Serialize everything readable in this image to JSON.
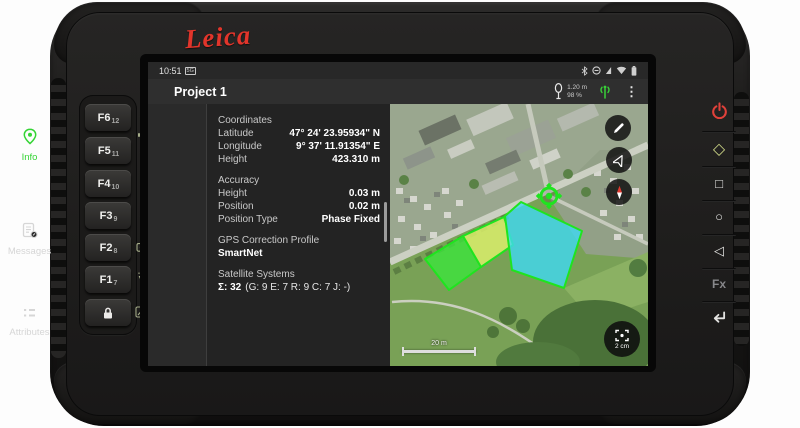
{
  "device": {
    "brand": "Leica",
    "left_keys": [
      {
        "label": "F6",
        "sub": "12"
      },
      {
        "label": "F5",
        "sub": "11"
      },
      {
        "label": "F4",
        "sub": "10"
      },
      {
        "label": "F3",
        "sub": "9"
      },
      {
        "label": "F2",
        "sub": "8"
      },
      {
        "label": "F1",
        "sub": "7"
      }
    ],
    "fx_label": "Fx",
    "side_icon_names": [
      "volume-up",
      "speaker",
      "volume-down",
      "brightness-up",
      "contrast",
      "brightness-down",
      "camera",
      "flashlight",
      "display-brightness"
    ],
    "right_button_names": [
      "power",
      "ok-diamond",
      "square",
      "circle",
      "back-triangle",
      "fx",
      "enter"
    ],
    "glyphs": {
      "diamond": "◇",
      "square": "□",
      "circle": "○",
      "triangle": "◁",
      "volume_up": "▲",
      "volume_down": "▼",
      "contrast": "◐",
      "menu_dots": "⋮"
    }
  },
  "statusbar": {
    "time": "10:51",
    "network_badge": "5G",
    "right_icon_names": [
      "bluetooth",
      "do-not-disturb",
      "sim-signal",
      "wifi",
      "battery"
    ]
  },
  "appbar": {
    "title": "Project 1",
    "antenna_height": "1.20 m",
    "battery_level": "98 %",
    "icon_names": [
      "pole-antenna",
      "rtk-signal",
      "overflow-menu"
    ]
  },
  "sidebar": {
    "tabs": [
      {
        "label": "Info",
        "icon": "position-pin-icon",
        "active": true
      },
      {
        "label": "Messages",
        "icon": "messages-icon",
        "active": false
      },
      {
        "label": "Attributes",
        "icon": "attributes-list-icon",
        "active": false
      }
    ]
  },
  "info": {
    "coordinates_heading": "Coordinates",
    "latitude_label": "Latitude",
    "latitude_value": "47° 24' 23.95934\" N",
    "longitude_label": "Longitude",
    "longitude_value": "9° 37' 11.91354\" E",
    "height_label": "Height",
    "height_value": "423.310 m",
    "accuracy_heading": "Accuracy",
    "acc_height_label": "Height",
    "acc_height_value": "0.03 m",
    "acc_position_label": "Position",
    "acc_position_value": "0.02 m",
    "acc_postype_label": "Position Type",
    "acc_postype_value": "Phase Fixed",
    "gps_profile_heading": "GPS Correction Profile",
    "gps_profile_value": "SmartNet",
    "satellites_heading": "Satellite Systems",
    "satellites_sum": "Σ: 32",
    "satellites_detail": "(G: 9  E: 7  R: 9  C: 7  J: -)"
  },
  "map": {
    "scale_label": "20 m",
    "zoom_button_label": "2 cm",
    "tool_names": [
      "edit-pencil",
      "follow-position",
      "compass-north"
    ],
    "accent_green": "#1fe41f",
    "parcel_fills": {
      "left": "#3ce53c",
      "middle": "#dbee6b",
      "right": "#3ed9f4"
    }
  },
  "colors": {
    "brand_red": "#e2352b",
    "active_green": "#35d435"
  }
}
